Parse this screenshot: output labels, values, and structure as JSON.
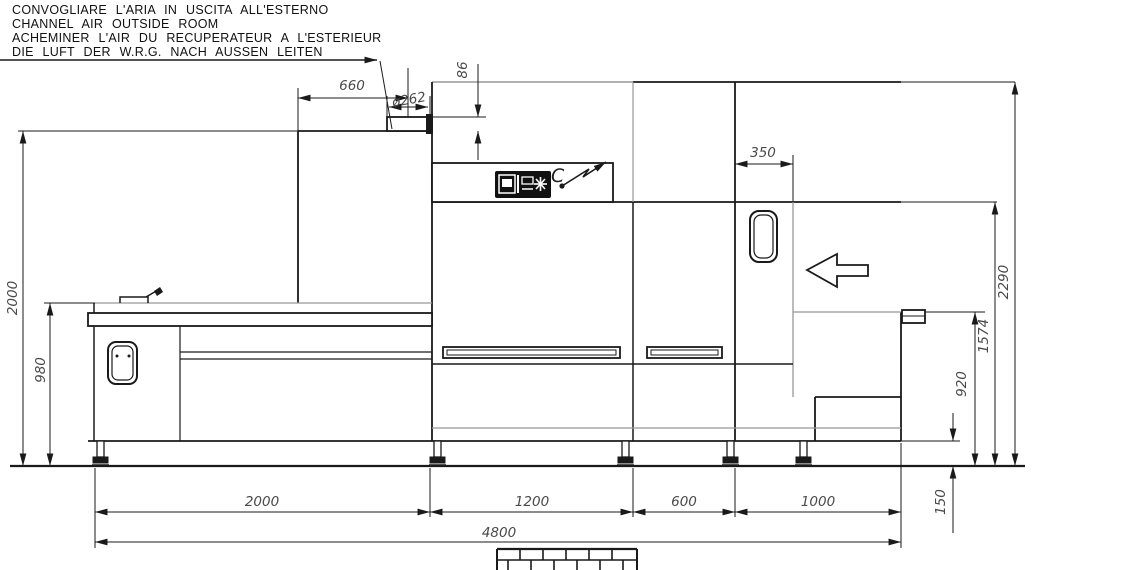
{
  "drawing": {
    "notes": [
      "CONVOGLIARE L'ARIA IN USCITA ALL'ESTERNO",
      "CHANNEL AIR OUTSIDE ROOM",
      "ACHEMINER L'AIR DU RECUPERATEUR A L'ESTERIEUR",
      "DIE LUFT DER W.R.G. NACH AUSSEN LEITEN"
    ],
    "connection_label": "C",
    "dims": {
      "duct_offset": "660",
      "duct_diameter": "ø262",
      "duct_stub_height": "86",
      "exit_opening_width": "350",
      "overall_height": "2290",
      "left_structure_height": "2000",
      "tunnel_top_height": "1574",
      "entry_table_height": "980",
      "exit_table_height": "920",
      "plinth_height": "150",
      "entry_section_length": "2000",
      "wash_section_length": "1200",
      "rinse_section_length": "600",
      "exit_section_length": "1000",
      "overall_length": "4800"
    },
    "colors": {
      "line": "#1a1a1a",
      "gray": "#979797",
      "background": "#ffffff"
    }
  }
}
